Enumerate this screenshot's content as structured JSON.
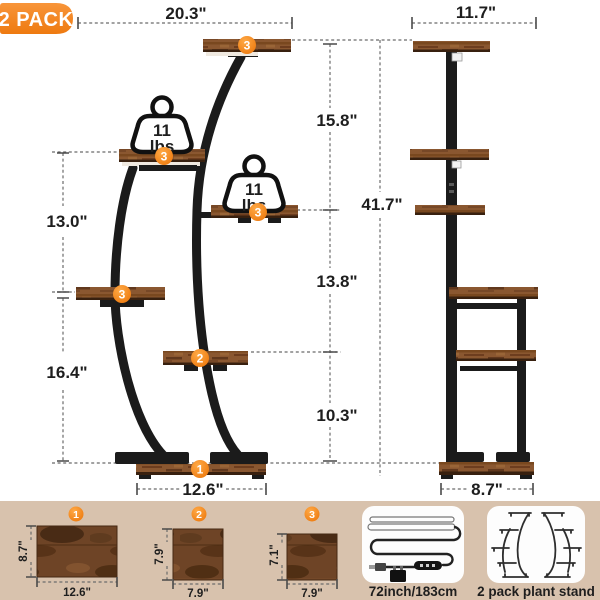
{
  "badge": {
    "label": "2 PACK"
  },
  "front_view": {
    "top_width": "20.3\"",
    "upper_left_height": "13.0\"",
    "lower_left_height": "16.4\"",
    "base_width": "12.6\"",
    "weight_capacity": {
      "value": "11",
      "unit": "lbs"
    },
    "shelf_markers": {
      "top": "3",
      "upper_left": "3",
      "upper_right": "3",
      "mid_left": "3",
      "lower_mid": "2",
      "base": "1"
    }
  },
  "side_view": {
    "top_depth": "11.7\"",
    "upper_height": "15.8\"",
    "total_height": "41.7\"",
    "middle_height": "13.8\"",
    "lower_height": "10.3\"",
    "base_depth": "8.7\""
  },
  "panels": [
    {
      "marker": "1",
      "width": "12.6\"",
      "height": "8.7\""
    },
    {
      "marker": "2",
      "width": "7.9\"",
      "height": "7.9\""
    },
    {
      "marker": "3",
      "width": "7.9\"",
      "height": "7.1\""
    }
  ],
  "accessories": {
    "led_strip": {
      "label": "72inch/183cm"
    },
    "stand_pack": {
      "label": "2 pack plant stand"
    }
  },
  "colors": {
    "accent_orange": "#F5841E",
    "strip_beige": "#D8C2AD",
    "wood_brown": "#8A5A33",
    "metal_black": "#1B1B1B"
  }
}
